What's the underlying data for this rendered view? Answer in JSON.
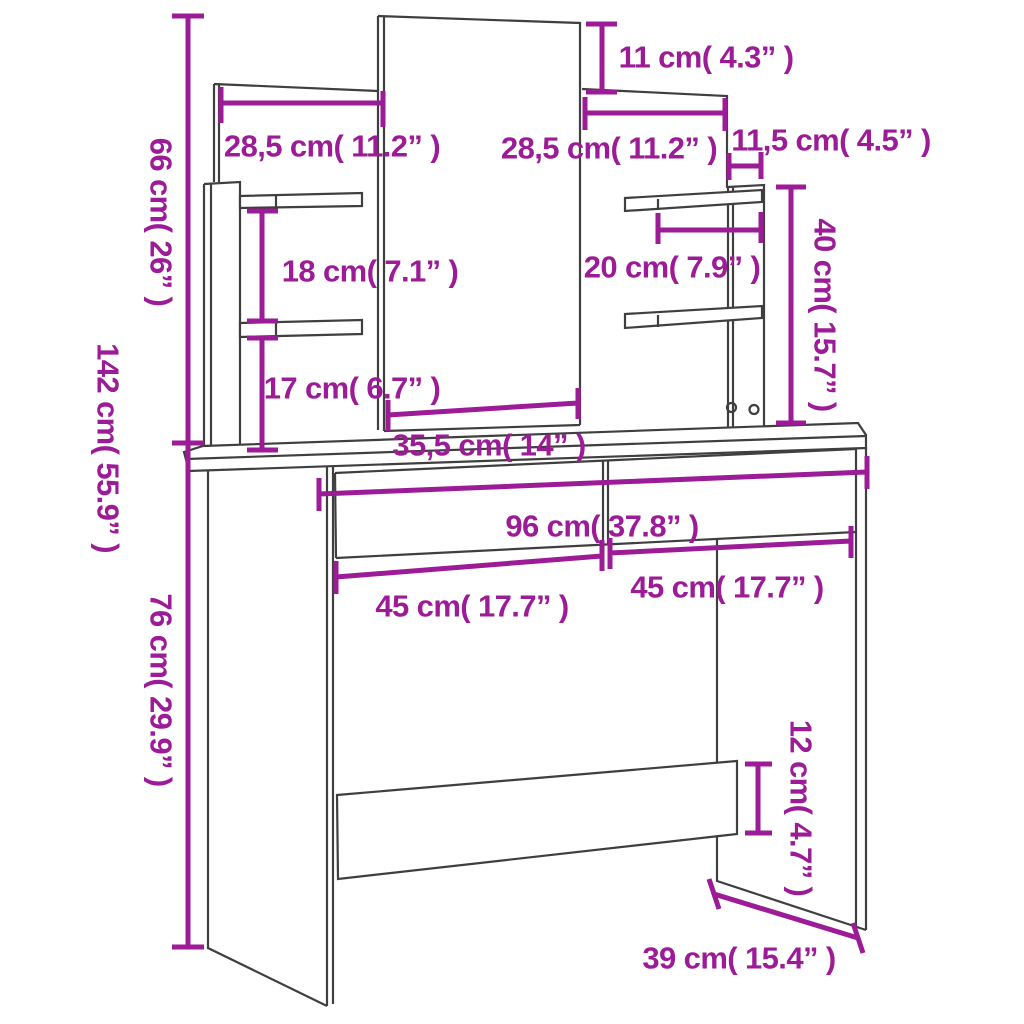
{
  "title": "Dressing table with mirror and shelves - dimension diagram",
  "colors": {
    "dimension": "#9C1B96",
    "outline": "#3F3F3F",
    "background": "#FFFFFF"
  },
  "labels": {
    "total_height": "142 cm( 55.9” )",
    "upper_height": "66 cm( 26” )",
    "table_height": "76 cm( 29.9” )",
    "mirror_top_offset": "11 cm( 4.3” )",
    "left_panel_width": "28,5 cm( 11.2” )",
    "right_panel_width": "28,5 cm( 11.2” )",
    "side_board_depth": "11,5 cm( 4.5” )",
    "right_unit_height": "40 cm( 15.7” )",
    "left_shelf_gap": "18 cm( 7.1” )",
    "right_shelf_length": "20 cm( 7.9” )",
    "left_lower_gap": "17 cm( 6.7” )",
    "mirror_width": "35,5 cm( 14” )",
    "tabletop_width": "96 cm( 37.8” )",
    "drawer_left_width": "45 cm( 17.7” )",
    "drawer_right_width": "45 cm( 17.7” )",
    "back_rail_height": "12 cm( 4.7” )",
    "table_depth": "39 cm( 15.4” )"
  }
}
